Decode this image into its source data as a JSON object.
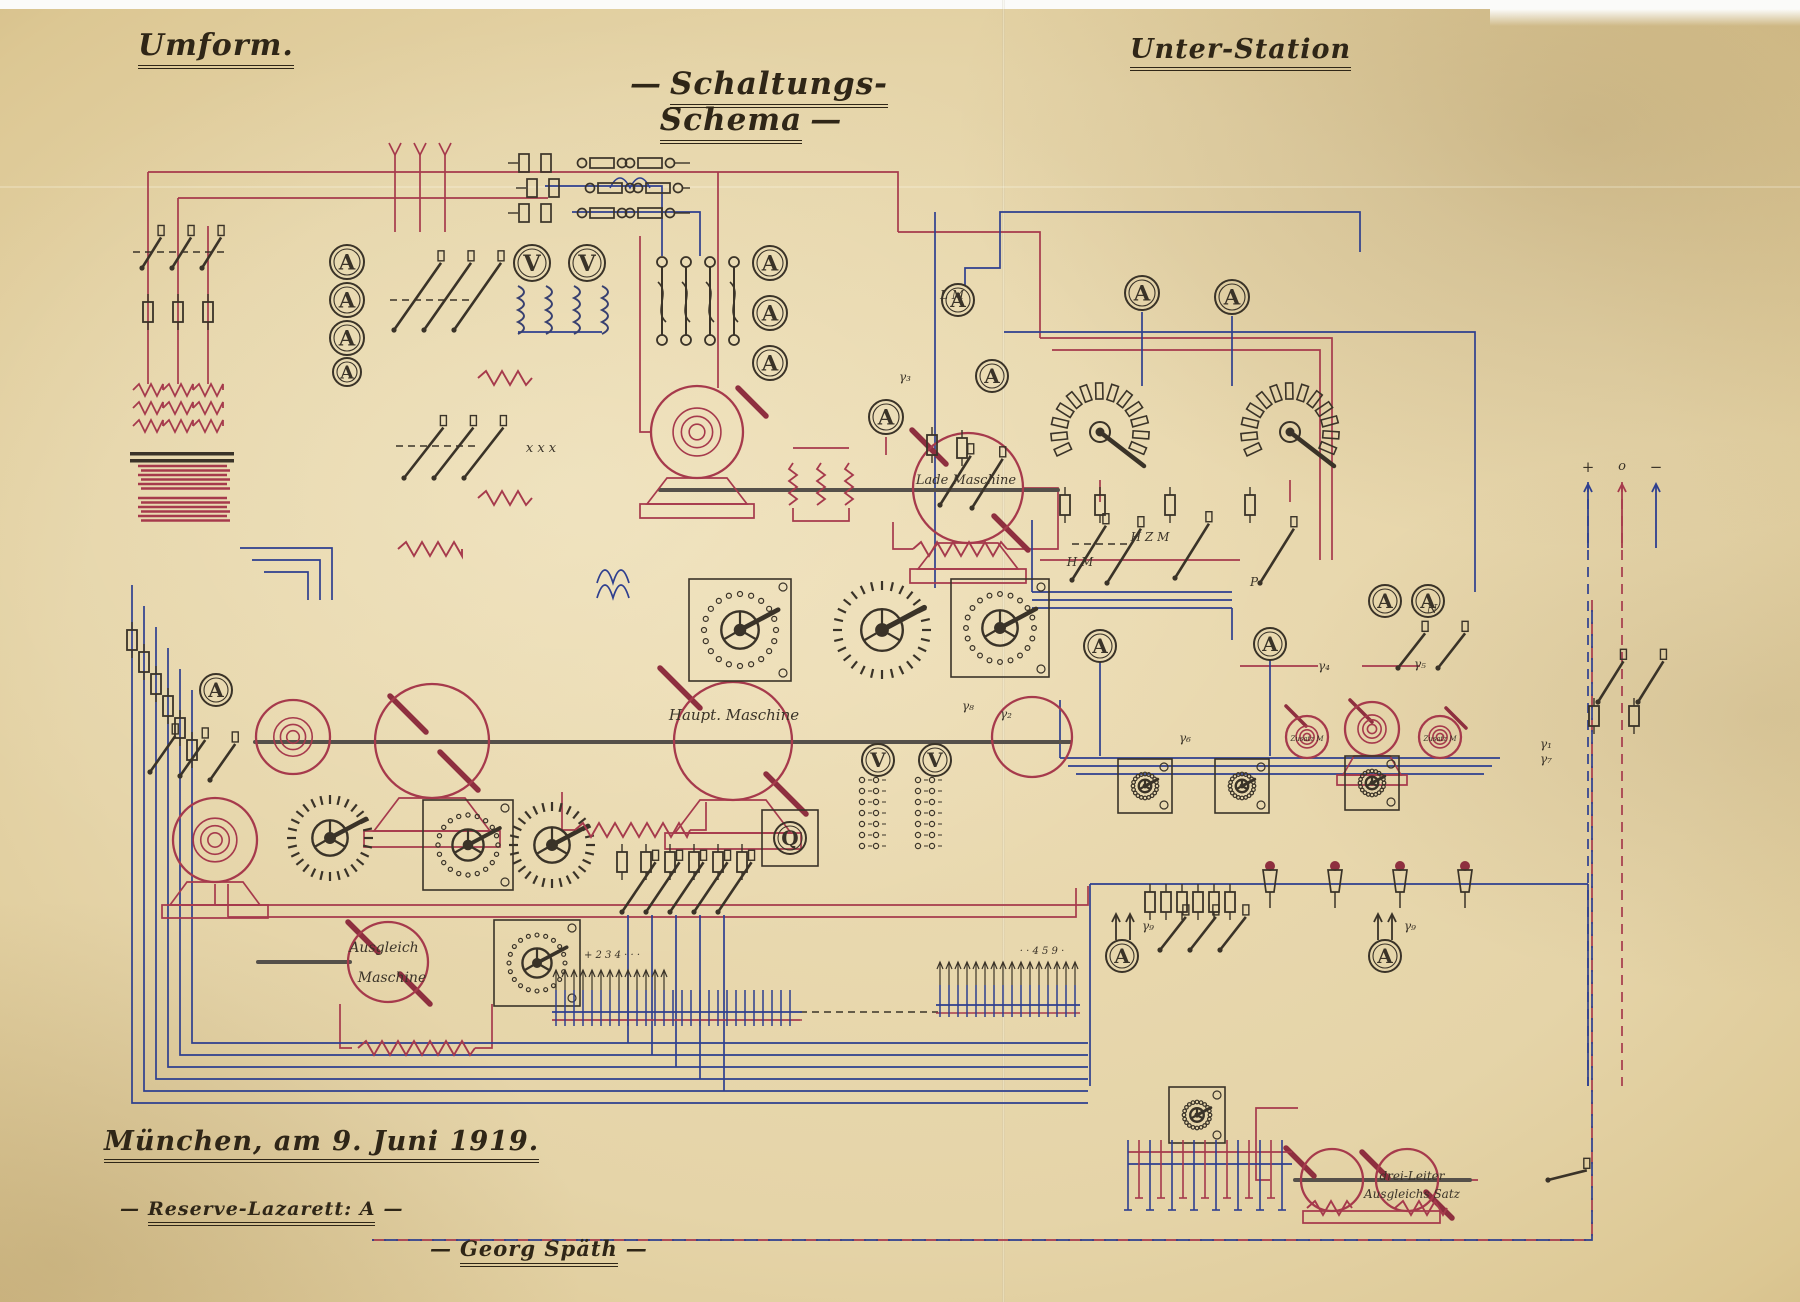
{
  "page": {
    "title_left": "Umform.",
    "title_center": "Schaltungs-Schema",
    "title_right": "Unter-Station",
    "dash": "—",
    "footer": {
      "place_date": "München, am 9. Juni  1919.",
      "unit": "Reserve-Lazarett: A",
      "signature": "Georg Späth"
    },
    "ink_red": "#a63a4c",
    "ink_dark_red": "#8e2f3f",
    "ink_blue": "#2e3f8f",
    "ink_black": "#3a3328",
    "paper": "#e7d7ad"
  },
  "diagram": {
    "labels": [
      {
        "t": "Lade Maschine",
        "x": 966,
        "y": 484,
        "s": 13
      },
      {
        "t": "Haupt. Maschine",
        "x": 734,
        "y": 720,
        "s": 15
      },
      {
        "t": "Ausgleich",
        "x": 384,
        "y": 952,
        "s": 14
      },
      {
        "t": "Maschine",
        "x": 392,
        "y": 982,
        "s": 14
      },
      {
        "t": "drei-Leiter",
        "x": 1412,
        "y": 1180,
        "s": 12
      },
      {
        "t": "Ausgleichs Satz",
        "x": 1412,
        "y": 1198,
        "s": 12
      },
      {
        "t": "Zusatz M",
        "x": 1307,
        "y": 741,
        "s": 7
      },
      {
        "t": "Zusatz M",
        "x": 1440,
        "y": 741,
        "s": 7
      },
      {
        "t": "L M",
        "x": 952,
        "y": 299,
        "s": 12
      },
      {
        "t": "H M",
        "x": 1080,
        "y": 566,
        "s": 12
      },
      {
        "t": "H Z M",
        "x": 1150,
        "y": 541,
        "s": 12
      },
      {
        "t": "P",
        "x": 1254,
        "y": 586,
        "s": 12
      },
      {
        "t": "N",
        "x": 1432,
        "y": 613,
        "s": 12
      },
      {
        "t": "x x x",
        "x": 541,
        "y": 452,
        "s": 13
      },
      {
        "t": "γ₁",
        "x": 1546,
        "y": 748,
        "s": 12
      },
      {
        "t": "γ₂",
        "x": 1006,
        "y": 718,
        "s": 12
      },
      {
        "t": "γ₃",
        "x": 905,
        "y": 381,
        "s": 12
      },
      {
        "t": "γ₄",
        "x": 1324,
        "y": 670,
        "s": 12
      },
      {
        "t": "γ₅",
        "x": 1420,
        "y": 668,
        "s": 12
      },
      {
        "t": "γ₆",
        "x": 1185,
        "y": 742,
        "s": 12
      },
      {
        "t": "γ₇",
        "x": 1546,
        "y": 763,
        "s": 12
      },
      {
        "t": "γ₈",
        "x": 968,
        "y": 710,
        "s": 12
      },
      {
        "t": "γ₉",
        "x": 1148,
        "y": 930,
        "s": 12
      },
      {
        "t": "γ₉",
        "x": 1410,
        "y": 930,
        "s": 12
      },
      {
        "t": "+",
        "x": 1588,
        "y": 472,
        "s": 15
      },
      {
        "t": "o",
        "x": 1622,
        "y": 470,
        "s": 13
      },
      {
        "t": "−",
        "x": 1656,
        "y": 472,
        "s": 15
      },
      {
        "t": "+ 2 3 4 · · ·",
        "x": 612,
        "y": 958,
        "s": 10
      },
      {
        "t": "· · 4 5 9 ·",
        "x": 1042,
        "y": 954,
        "s": 10
      }
    ],
    "meters": [
      {
        "x": 347,
        "y": 262,
        "r": 17,
        "l": "A"
      },
      {
        "x": 347,
        "y": 300,
        "r": 17,
        "l": "A"
      },
      {
        "x": 347,
        "y": 338,
        "r": 17,
        "l": "A"
      },
      {
        "x": 347,
        "y": 372,
        "r": 14,
        "l": "A"
      },
      {
        "x": 770,
        "y": 263,
        "r": 17,
        "l": "A"
      },
      {
        "x": 770,
        "y": 313,
        "r": 17,
        "l": "A"
      },
      {
        "x": 770,
        "y": 363,
        "r": 17,
        "l": "A"
      },
      {
        "x": 886,
        "y": 417,
        "r": 17,
        "l": "A"
      },
      {
        "x": 958,
        "y": 300,
        "r": 16,
        "l": "A"
      },
      {
        "x": 992,
        "y": 376,
        "r": 16,
        "l": "A"
      },
      {
        "x": 1142,
        "y": 293,
        "r": 17,
        "l": "A"
      },
      {
        "x": 1232,
        "y": 297,
        "r": 17,
        "l": "A"
      },
      {
        "x": 216,
        "y": 690,
        "r": 16,
        "l": "A"
      },
      {
        "x": 1100,
        "y": 646,
        "r": 16,
        "l": "A"
      },
      {
        "x": 1270,
        "y": 644,
        "r": 16,
        "l": "A"
      },
      {
        "x": 1385,
        "y": 601,
        "r": 16,
        "l": "A"
      },
      {
        "x": 1428,
        "y": 601,
        "r": 16,
        "l": "A"
      },
      {
        "x": 1122,
        "y": 956,
        "r": 16,
        "l": "A"
      },
      {
        "x": 1385,
        "y": 956,
        "r": 16,
        "l": "A"
      },
      {
        "x": 532,
        "y": 263,
        "r": 18,
        "l": "V"
      },
      {
        "x": 587,
        "y": 263,
        "r": 18,
        "l": "V"
      },
      {
        "x": 878,
        "y": 760,
        "r": 16,
        "l": "V"
      },
      {
        "x": 935,
        "y": 760,
        "r": 16,
        "l": "V"
      },
      {
        "x": 790,
        "y": 838,
        "r": 16,
        "l": "Q",
        "boxed": 1
      }
    ],
    "machines": [
      {
        "x": 697,
        "y": 432,
        "r": 46,
        "sp": 1
      },
      {
        "x": 968,
        "y": 488,
        "r": 55,
        "sp": 0
      },
      {
        "x": 293,
        "y": 737,
        "r": 37,
        "sp": 1
      },
      {
        "x": 432,
        "y": 741,
        "r": 57,
        "sp": 0
      },
      {
        "x": 733,
        "y": 741,
        "r": 59,
        "sp": 0
      },
      {
        "x": 1032,
        "y": 737,
        "r": 40,
        "sp": 0
      },
      {
        "x": 215,
        "y": 840,
        "r": 42,
        "sp": 1
      },
      {
        "x": 388,
        "y": 962,
        "r": 40,
        "sp": 0
      },
      {
        "x": 1307,
        "y": 737,
        "r": 21,
        "sp": 1
      },
      {
        "x": 1372,
        "y": 729,
        "r": 27,
        "sp": 1
      },
      {
        "x": 1440,
        "y": 737,
        "r": 21,
        "sp": 1
      },
      {
        "x": 1332,
        "y": 1180,
        "r": 31,
        "sp": 0
      },
      {
        "x": 1407,
        "y": 1180,
        "r": 31,
        "sp": 0
      }
    ],
    "dials": [
      {
        "x": 740,
        "y": 630,
        "r": 36,
        "st": "dots",
        "bx": 1
      },
      {
        "x": 882,
        "y": 630,
        "r": 40,
        "st": "spikes",
        "bx": 0
      },
      {
        "x": 1000,
        "y": 628,
        "r": 34,
        "st": "dots",
        "bx": 1
      },
      {
        "x": 468,
        "y": 845,
        "r": 30,
        "st": "dots",
        "bx": 1
      },
      {
        "x": 552,
        "y": 845,
        "r": 34,
        "st": "spikes",
        "bx": 0
      },
      {
        "x": 330,
        "y": 838,
        "r": 34,
        "st": "spikes",
        "bx": 0
      },
      {
        "x": 537,
        "y": 963,
        "r": 28,
        "st": "dots",
        "bx": 1
      },
      {
        "x": 1145,
        "y": 786,
        "r": 12,
        "st": "dots",
        "bx": 1
      },
      {
        "x": 1242,
        "y": 786,
        "r": 12,
        "st": "dots",
        "bx": 1
      },
      {
        "x": 1372,
        "y": 783,
        "r": 12,
        "st": "dots",
        "bx": 1
      },
      {
        "x": 1197,
        "y": 1115,
        "r": 13,
        "st": "dots",
        "bx": 1
      }
    ],
    "cellswitches": [
      {
        "x": 1100,
        "y": 432
      },
      {
        "x": 1290,
        "y": 432
      }
    ],
    "resistors": [
      {
        "x1": 913,
        "x2": 1007,
        "y": 549
      },
      {
        "x1": 575,
        "x2": 690,
        "y": 830
      },
      {
        "x1": 358,
        "x2": 475,
        "y": 1048
      },
      {
        "x1": 478,
        "x2": 532,
        "y": 378
      },
      {
        "x1": 478,
        "x2": 532,
        "y": 498
      },
      {
        "x1": 398,
        "x2": 462,
        "y": 549
      },
      {
        "x1": 1307,
        "x2": 1352,
        "y": 1208
      },
      {
        "x1": 1395,
        "x2": 1447,
        "y": 1208
      }
    ],
    "vzigzags": [
      {
        "x": 793,
        "y": 463,
        "h": 42
      },
      {
        "x": 821,
        "y": 463,
        "h": 42
      },
      {
        "x": 849,
        "y": 463,
        "h": 42
      }
    ],
    "springs": [
      {
        "x": 138,
        "y": 466,
        "w": 92,
        "n": 6
      },
      {
        "x": 138,
        "y": 498,
        "w": 92,
        "n": 6
      }
    ],
    "coilcols": [
      {
        "x": 148,
        "y": 390
      },
      {
        "x": 178,
        "y": 390
      },
      {
        "x": 208,
        "y": 390
      }
    ],
    "vcoils": [
      {
        "x": 518,
        "y": 286
      },
      {
        "x": 546,
        "y": 286
      },
      {
        "x": 574,
        "y": 286
      },
      {
        "x": 602,
        "y": 286
      }
    ],
    "fuses": [
      {
        "x": 148,
        "y": 312
      },
      {
        "x": 178,
        "y": 312
      },
      {
        "x": 208,
        "y": 312
      },
      {
        "x": 132,
        "y": 640
      },
      {
        "x": 144,
        "y": 662
      },
      {
        "x": 156,
        "y": 684
      },
      {
        "x": 168,
        "y": 706
      },
      {
        "x": 180,
        "y": 728
      },
      {
        "x": 192,
        "y": 750
      },
      {
        "x": 622,
        "y": 862
      },
      {
        "x": 646,
        "y": 862
      },
      {
        "x": 670,
        "y": 862
      },
      {
        "x": 694,
        "y": 862
      },
      {
        "x": 718,
        "y": 862
      },
      {
        "x": 742,
        "y": 862
      },
      {
        "x": 932,
        "y": 445
      },
      {
        "x": 962,
        "y": 448
      },
      {
        "x": 1065,
        "y": 505
      },
      {
        "x": 1100,
        "y": 505
      },
      {
        "x": 1170,
        "y": 505
      },
      {
        "x": 1250,
        "y": 505
      },
      {
        "x": 1594,
        "y": 716
      },
      {
        "x": 1634,
        "y": 716
      },
      {
        "x": 1150,
        "y": 902
      },
      {
        "x": 1166,
        "y": 902
      },
      {
        "x": 1182,
        "y": 902
      },
      {
        "x": 1198,
        "y": 902
      },
      {
        "x": 1214,
        "y": 902
      },
      {
        "x": 1230,
        "y": 902
      }
    ],
    "switches": [
      {
        "x": 142,
        "y": 268,
        "len": 36,
        "a": -58
      },
      {
        "x": 172,
        "y": 268,
        "len": 36,
        "a": -58
      },
      {
        "x": 202,
        "y": 268,
        "len": 36,
        "a": -58
      },
      {
        "x": 394,
        "y": 330,
        "len": 82,
        "a": -55
      },
      {
        "x": 424,
        "y": 330,
        "len": 82,
        "a": -55
      },
      {
        "x": 454,
        "y": 330,
        "len": 82,
        "a": -55
      },
      {
        "x": 404,
        "y": 478,
        "len": 64,
        "a": -52
      },
      {
        "x": 434,
        "y": 478,
        "len": 64,
        "a": -52
      },
      {
        "x": 464,
        "y": 478,
        "len": 64,
        "a": -52
      },
      {
        "x": 150,
        "y": 772,
        "len": 44,
        "a": -55
      },
      {
        "x": 180,
        "y": 776,
        "len": 44,
        "a": -55
      },
      {
        "x": 210,
        "y": 780,
        "len": 44,
        "a": -55
      },
      {
        "x": 622,
        "y": 912,
        "len": 60,
        "a": -56
      },
      {
        "x": 646,
        "y": 912,
        "len": 60,
        "a": -56
      },
      {
        "x": 670,
        "y": 912,
        "len": 60,
        "a": -56
      },
      {
        "x": 694,
        "y": 912,
        "len": 60,
        "a": -56
      },
      {
        "x": 718,
        "y": 912,
        "len": 60,
        "a": -56
      },
      {
        "x": 940,
        "y": 505,
        "len": 58,
        "a": -58
      },
      {
        "x": 972,
        "y": 508,
        "len": 58,
        "a": -58
      },
      {
        "x": 1072,
        "y": 580,
        "len": 64,
        "a": -58
      },
      {
        "x": 1107,
        "y": 583,
        "len": 64,
        "a": -58
      },
      {
        "x": 1175,
        "y": 578,
        "len": 64,
        "a": -58
      },
      {
        "x": 1260,
        "y": 583,
        "len": 64,
        "a": -58
      },
      {
        "x": 1598,
        "y": 702,
        "len": 48,
        "a": -58
      },
      {
        "x": 1638,
        "y": 702,
        "len": 48,
        "a": -58
      },
      {
        "x": 1398,
        "y": 668,
        "len": 44,
        "a": -52
      },
      {
        "x": 1438,
        "y": 668,
        "len": 44,
        "a": -52
      },
      {
        "x": 1160,
        "y": 950,
        "len": 42,
        "a": -52
      },
      {
        "x": 1190,
        "y": 950,
        "len": 42,
        "a": -52
      },
      {
        "x": 1220,
        "y": 950,
        "len": 42,
        "a": -52
      },
      {
        "x": 1548,
        "y": 1180,
        "len": 40,
        "a": -14
      }
    ],
    "sswitches": [
      {
        "x": 662,
        "y": 262
      },
      {
        "x": 686,
        "y": 262
      },
      {
        "x": 710,
        "y": 262
      },
      {
        "x": 734,
        "y": 262
      }
    ],
    "cartridgerows": [
      {
        "x": 524,
        "y": 163
      },
      {
        "x": 532,
        "y": 188
      },
      {
        "x": 524,
        "y": 213
      }
    ],
    "dashes": [
      {
        "x1": 133,
        "y1": 252,
        "x2": 224,
        "y2": 252
      },
      {
        "x1": 390,
        "y1": 300,
        "x2": 472,
        "y2": 300
      },
      {
        "x1": 396,
        "y1": 446,
        "x2": 476,
        "y2": 446
      },
      {
        "x1": 1072,
        "y1": 544,
        "x2": 1130,
        "y2": 544
      },
      {
        "x1": 800,
        "y1": 1012,
        "x2": 938,
        "y2": 1012
      }
    ],
    "arrows": [
      {
        "x": 1588,
        "y1": 548,
        "y2": 484,
        "c": "blue"
      },
      {
        "x": 1622,
        "y1": 548,
        "y2": 484,
        "c": "red"
      },
      {
        "x": 1656,
        "y1": 548,
        "y2": 484,
        "c": "blue"
      },
      {
        "x": 1116,
        "y1": 940,
        "y2": 914,
        "c": "black"
      },
      {
        "x": 1130,
        "y1": 940,
        "y2": 914,
        "c": "black"
      },
      {
        "x": 1378,
        "y1": 940,
        "y2": 914,
        "c": "black"
      },
      {
        "x": 1392,
        "y1": 940,
        "y2": 914,
        "c": "black"
      }
    ],
    "bushings": [
      {
        "x": 1270,
        "y": 866
      },
      {
        "x": 1335,
        "y": 866
      },
      {
        "x": 1400,
        "y": 866
      },
      {
        "x": 1465,
        "y": 866
      }
    ],
    "tapgrids": [
      {
        "x": 862,
        "y": 780
      },
      {
        "x": 918,
        "y": 780
      }
    ],
    "combs": [
      {
        "x1": 556,
        "x2": 798,
        "y": 1012,
        "step": 9,
        "up": 22,
        "dn": 14,
        "arrows": 13,
        "arrowY": 970,
        "dir": "up"
      },
      {
        "x1": 940,
        "x2": 1076,
        "y": 1005,
        "step": 9,
        "up": 20,
        "dn": 12,
        "arrows": 16,
        "arrowY": 962,
        "dir": "up"
      },
      {
        "x1": 1128,
        "x2": 1292,
        "y": 1152,
        "step": 11,
        "dir": "down"
      }
    ]
  }
}
